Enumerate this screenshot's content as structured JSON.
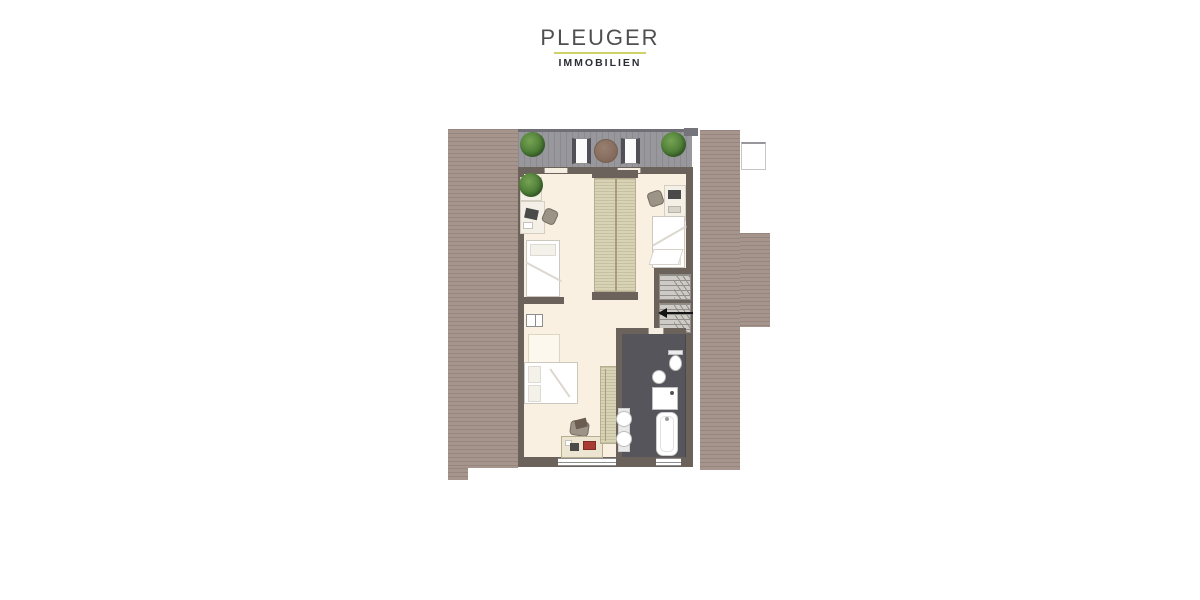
{
  "brand": {
    "name": "PLEUGER",
    "tagline": "IMMOBILIEN"
  },
  "colors": {
    "brand_name_text": "#4f4f4f",
    "brand_underline": "#d0d169",
    "brand_tagline_text": "#2b2e35",
    "roof": "#a6958c",
    "roof_stripe": "#97867d",
    "balcony_deck": "#97979c",
    "wall": "#6b625c",
    "interior_floor": "#f9f0e2",
    "wardrobe": "#d9d3b5",
    "bathroom_floor": "#57555c",
    "stair_tread": "#cecbc7",
    "plant_green": "#4c7c36",
    "balcony_table_brown": "#83685a",
    "furniture_white": "#ffffff"
  },
  "floor_plan": {
    "level": "attic",
    "balcony": {
      "name": "balcony-terrace",
      "items": [
        "potted-plant",
        "chair",
        "round-table",
        "chair",
        "potted-plant"
      ]
    },
    "rooms": [
      {
        "name": "bedroom-upper-left",
        "furniture": [
          "potted-plant",
          "desk",
          "chair",
          "single-bed"
        ]
      },
      {
        "name": "bedroom-upper-right",
        "furniture": [
          "desk",
          "chair",
          "single-bed"
        ]
      },
      {
        "name": "bedroom-lower-left",
        "furniture": [
          "floor-skylight",
          "double-bed",
          "chair",
          "desk",
          "wardrobe",
          "knee-wall-window"
        ]
      },
      {
        "name": "bathroom",
        "fixtures": [
          "toilet",
          "corner-washbasin",
          "shower",
          "bathtub",
          "double-washbasin"
        ]
      },
      {
        "name": "hallway",
        "features": [
          "u-shaped-staircase",
          "stair-direction-arrow",
          "roof-window"
        ]
      }
    ],
    "built_ins": [
      "double-sided-wardrobe"
    ],
    "stair_arrow_direction": "left"
  }
}
